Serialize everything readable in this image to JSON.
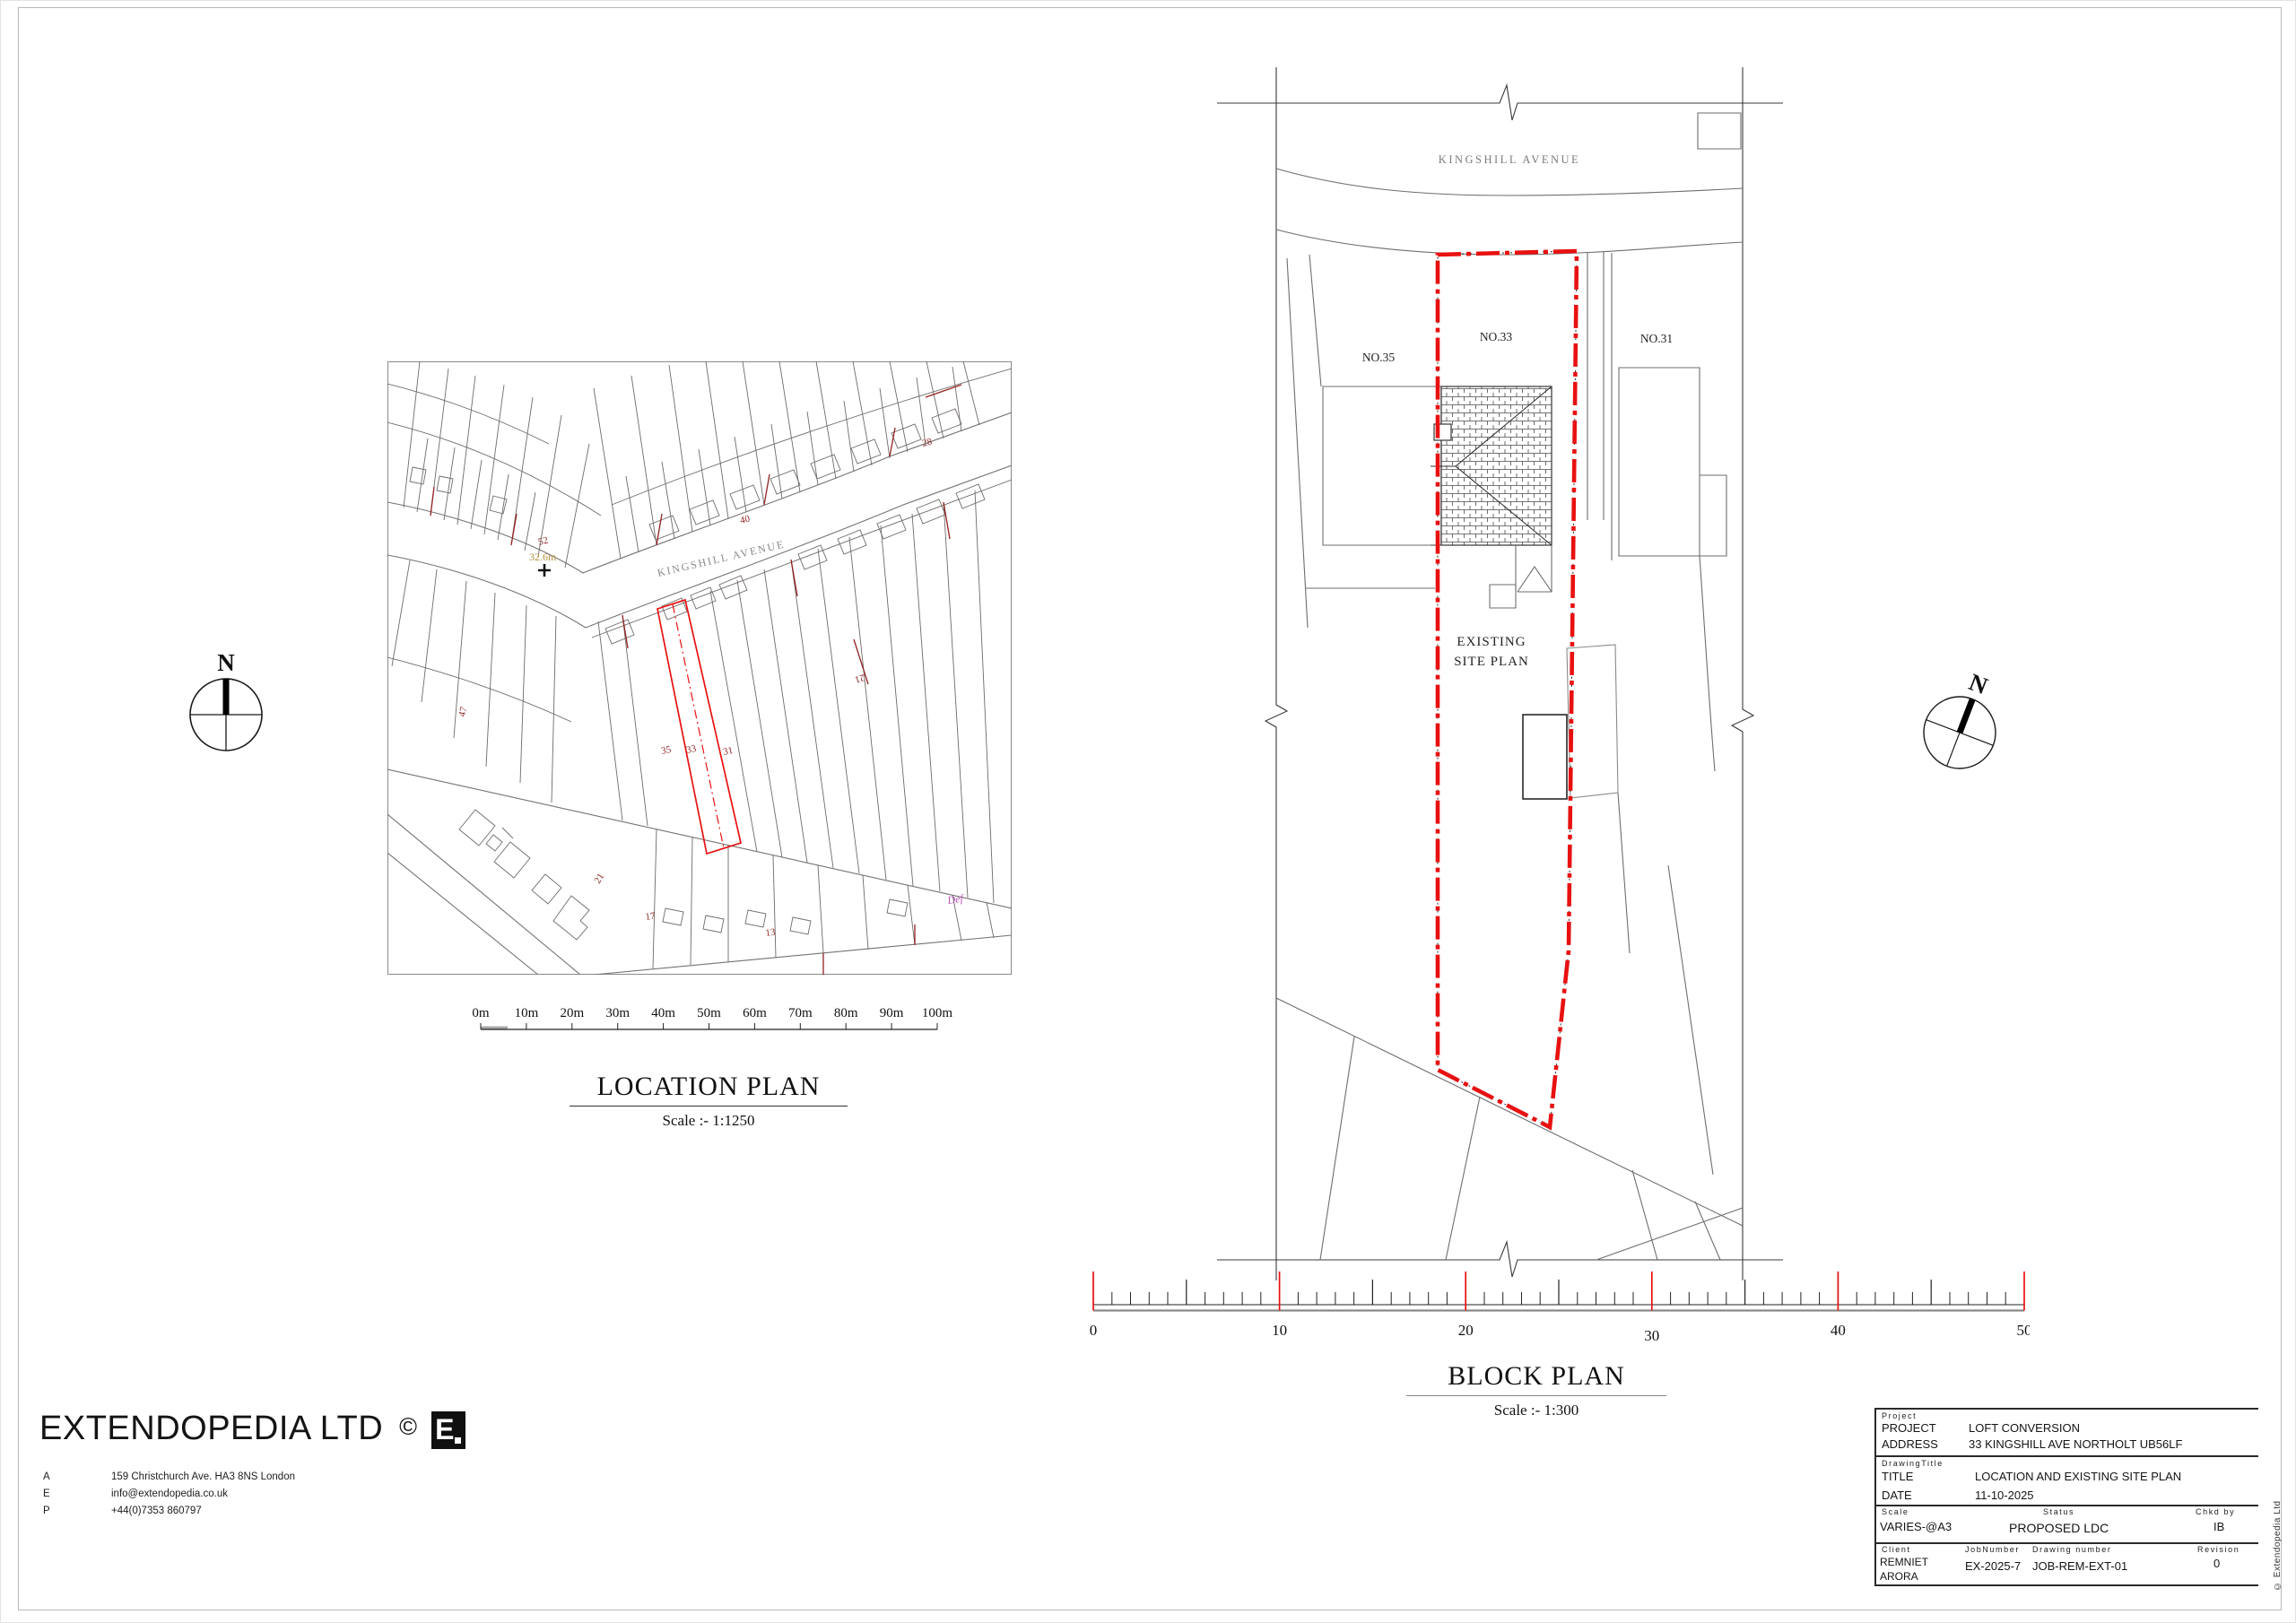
{
  "colors": {
    "boundary_red": "#e81111",
    "map_accent_red": "#932222",
    "benchmark_tan": "#b5913f",
    "def_magenta": "#b84fb8",
    "street_gray": "#8a8a8a"
  },
  "location_plan": {
    "title": "LOCATION PLAN",
    "scale_text": "Scale :- 1:1250",
    "street": "KINGSHILL AVENUE",
    "spot_height": "32.6m",
    "def_label": "Def",
    "nums": {
      "n52": "52",
      "n40": "40",
      "n28": "28",
      "n47": "47",
      "n21": "21",
      "n21b": "21",
      "n35": "35",
      "n33": "33",
      "n31": "31",
      "n17": "17",
      "n13": "13"
    },
    "ticks": [
      "0m",
      "10m",
      "20m",
      "30m",
      "40m",
      "50m",
      "60m",
      "70m",
      "80m",
      "90m",
      "100m"
    ]
  },
  "block_plan": {
    "title": "BLOCK PLAN",
    "scale_text": "Scale :- 1:300",
    "street": "KINGSHILL AVENUE",
    "no35": "NO.35",
    "no33": "NO.33",
    "no31": "NO.31",
    "existing_1": "EXISTING",
    "existing_2": "SITE PLAN",
    "ticks": [
      "0",
      "10",
      "20",
      "30",
      "40",
      "50"
    ]
  },
  "compass": {
    "north": "N"
  },
  "footer": {
    "company": "EXTENDOPEDIA LTD",
    "copyright": "©",
    "logo_letter": "E",
    "rows": [
      {
        "k": "A",
        "v": "159 Christchurch Ave. HA3 8NS London"
      },
      {
        "k": "E",
        "v": "info@extendopedia.co.uk"
      },
      {
        "k": "P",
        "v": "+44(0)7353 860797"
      }
    ]
  },
  "title_block": {
    "section_project": "Project",
    "project_label": "PROJECT",
    "project_value": "LOFT CONVERSION",
    "address_label": "ADDRESS",
    "address_value": "33 KINGSHILL AVE NORTHOLT UB56LF",
    "section_drawing": "DrawingTitle",
    "title_label": "TITLE",
    "title_value": "LOCATION AND EXISTING SITE PLAN",
    "date_label": "DATE",
    "date_value": "11-10-2025",
    "scale_label": "Scale",
    "scale_value": "VARIES-@A3",
    "status_label": "Status",
    "status_value": "PROPOSED LDC",
    "chkd_label": "Chkd by",
    "chkd_value": "IB",
    "client_label": "Client",
    "client_line1": "REMNIET",
    "client_line2": "ARORA",
    "job_label": "JobNumber",
    "job_value": "EX-2025-7",
    "dwg_label": "Drawing number",
    "dwg_value": "JOB-REM-EXT-01",
    "rev_label": "Revision",
    "rev_value": "0",
    "side_copyright": "© Extendopedia Ltd"
  }
}
